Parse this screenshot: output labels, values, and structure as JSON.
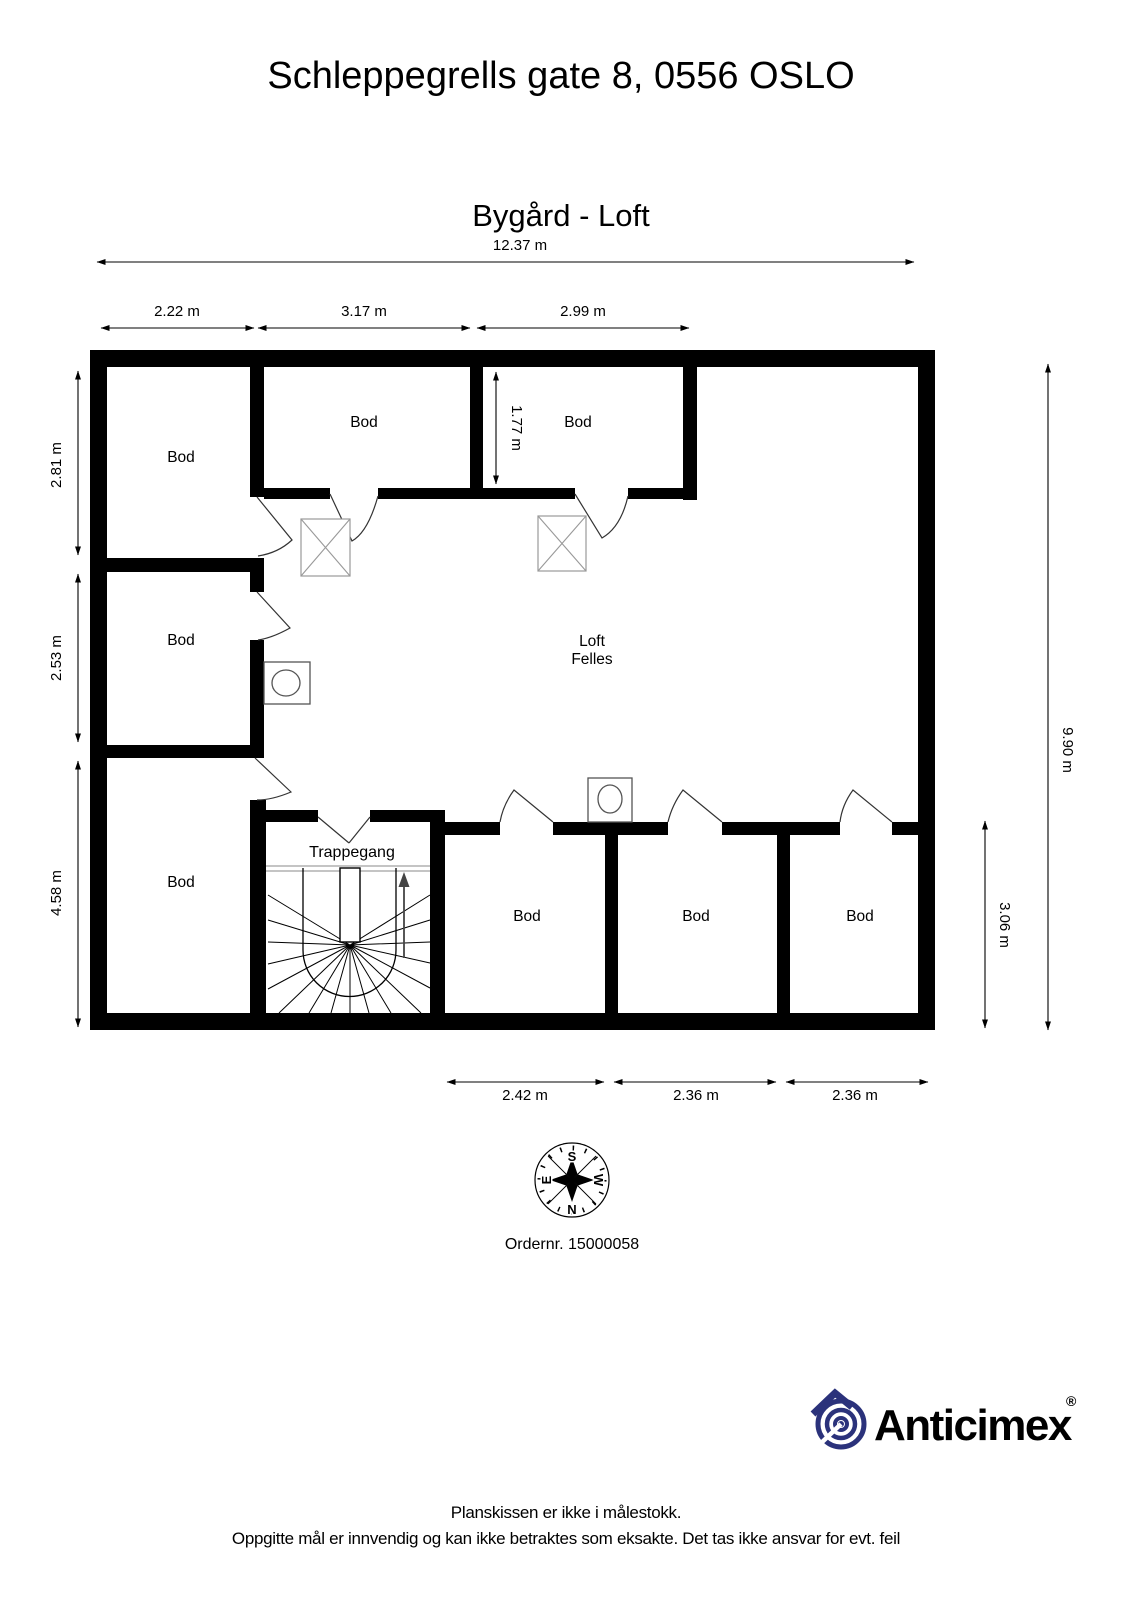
{
  "page": {
    "title": "Schleppegrells gate 8, 0556 OSLO",
    "subtitle": "Bygård - Loft"
  },
  "plan": {
    "rooms": [
      {
        "label": "Bod"
      },
      {
        "label": "Bod"
      },
      {
        "label": "Bod"
      },
      {
        "label": "Bod"
      },
      {
        "label": "Bod"
      },
      {
        "label": "Loft",
        "label2": "Felles"
      },
      {
        "label": "Trappegang"
      },
      {
        "label": "Bod"
      },
      {
        "label": "Bod"
      },
      {
        "label": "Bod"
      }
    ],
    "dimensions": {
      "total_width": "12.37 m",
      "top": [
        "2.22 m",
        "3.17 m",
        "2.99 m"
      ],
      "left": [
        "2.81 m",
        "2.53 m",
        "4.58 m"
      ],
      "inner_top_room_depth": "1.77 m",
      "right_total": "9.90 m",
      "right_bottom_rooms": "3.06 m",
      "bottom": [
        "2.42 m",
        "2.36 m",
        "2.36 m"
      ]
    }
  },
  "compass": {
    "south": "S",
    "east": "E",
    "west": "W",
    "north": "N"
  },
  "order_number": "Ordernr. 15000058",
  "brand": {
    "name": "Anticimex",
    "registered": "®",
    "color": "#2b327b"
  },
  "footer": {
    "line1": "Planskissen er ikke i målestokk.",
    "line2": "Oppgitte mål er innvendig og kan ikke betraktes som eksakte. Det tas ikke ansvar for evt. feil"
  }
}
